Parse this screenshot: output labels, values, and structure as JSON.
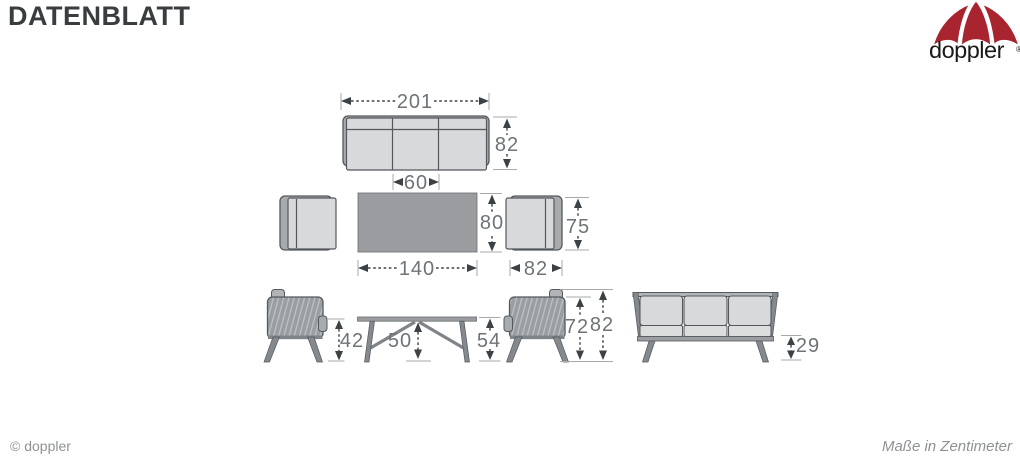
{
  "header": {
    "title": "DATENBLATT"
  },
  "logo": {
    "brand": "doppler",
    "registered_mark": "®"
  },
  "footer": {
    "copyright": "© doppler",
    "units_note": "Maße in Zentimeter"
  },
  "diagram": {
    "sofa_top": {
      "width": "201",
      "depth": "82",
      "middle_seat_width": "60"
    },
    "table_top": {
      "width": "140",
      "depth": "80"
    },
    "chair_top": {
      "width": "82",
      "depth": "75"
    },
    "chair_side": {
      "seat_height": "42",
      "back_height": "72",
      "total_height": "82"
    },
    "table_side": {
      "clearance_height": "50",
      "total_height": "54"
    },
    "sofa_front": {
      "seat_height": "29"
    }
  },
  "colors": {
    "brand_red": "#a8242e",
    "outline_gray": "#55595e",
    "dimension_text_gray": "#6e7377",
    "seat_light_gray": "#d8d9da",
    "table_gray": "#9a9c9f"
  }
}
